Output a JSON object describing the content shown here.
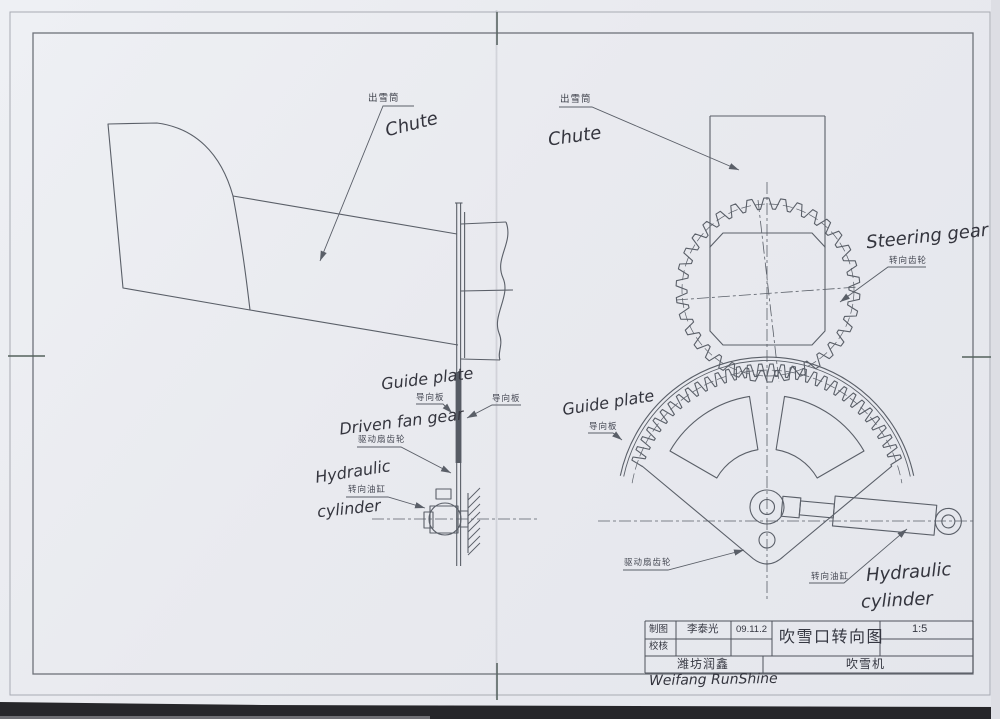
{
  "colors": {
    "paper": "#e9eaef",
    "line": "#5a5f68",
    "ink": "#34353e",
    "frame": "#70747c",
    "scan_band": "#26262a"
  },
  "left_view": {
    "labels": {
      "chute_cn": "出雪筒",
      "chute_hand": "Chute",
      "guide_plate_hand": "Guide plate",
      "guide_plate_cn_left": "导向板",
      "guide_plate_cn_right": "导向板",
      "driven_fan_gear_hand": "Driven fan gear",
      "driven_fan_gear_cn": "驱动扇齿轮",
      "hydraulic_hand_line1": "Hydraulic",
      "hydraulic_hand_line2": "cylinder",
      "hydraulic_cn": "转向油缸"
    }
  },
  "right_view": {
    "labels": {
      "chute_cn": "出雪筒",
      "chute_hand": "Chute",
      "steering_gear_hand": "Steering gear",
      "steering_gear_cn": "转向齿轮",
      "guide_plate_hand": "Guide plate",
      "guide_plate_cn": "导向板",
      "driven_fan_gear_cn": "驱动扇齿轮",
      "hydraulic_cn": "转向油缸",
      "hydraulic_hand_line1": "Hydraulic",
      "hydraulic_hand_line2": "cylinder"
    }
  },
  "title_block": {
    "drawn_label": "制图",
    "drawn_by": "李泰光",
    "drawn_date": "09.11.2",
    "checked_label": "校核",
    "title": "吹雪口转向图",
    "scale": "1:5",
    "company_cn": "潍坊润鑫",
    "product_cn": "吹雪机",
    "company_hand": "Weifang RunShine"
  }
}
